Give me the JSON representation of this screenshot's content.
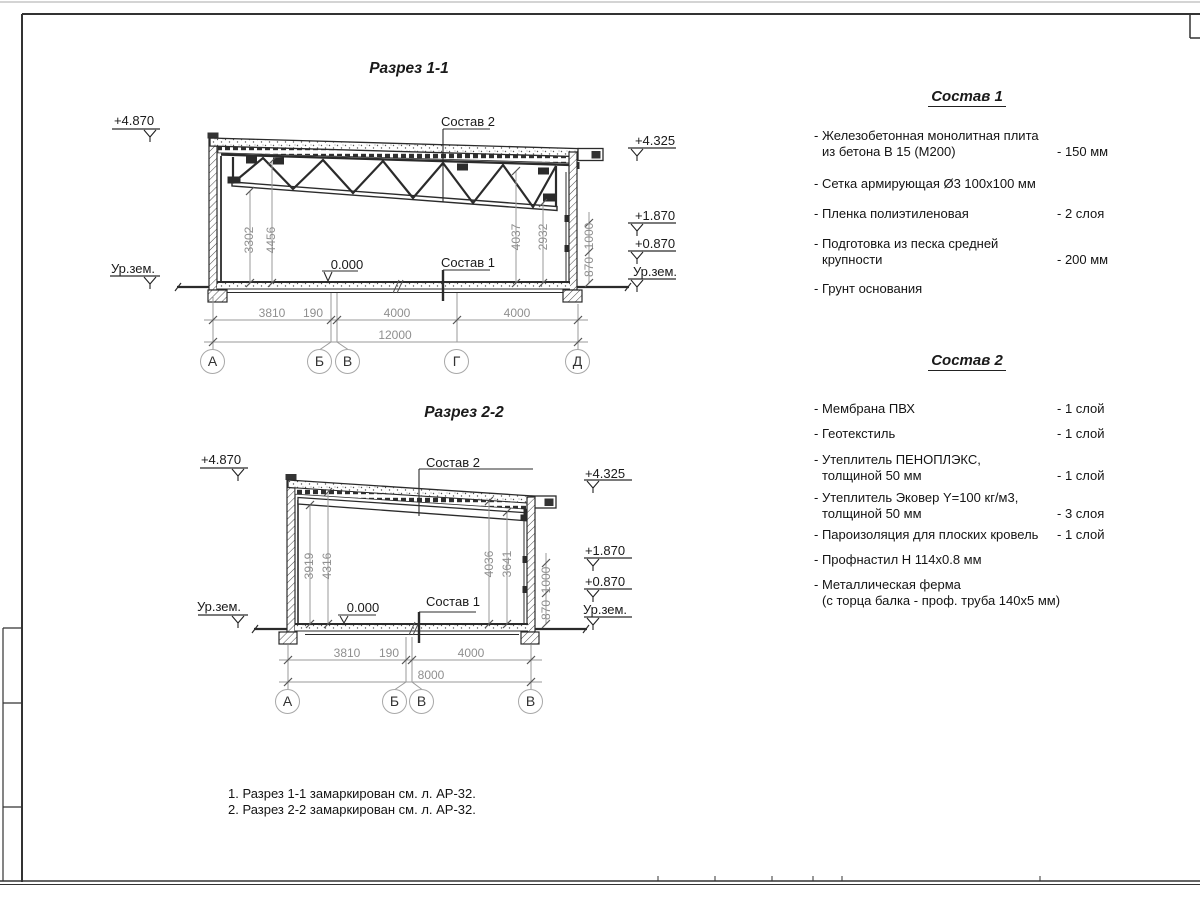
{
  "s1": {
    "title": "Разрез 1-1",
    "label_sostav2": "Состав 2",
    "label_sostav1": "Состав 1",
    "zero": "0.000",
    "mark_top_left": "+4.870",
    "mark_ground_left": "Ур.зем.",
    "marks_right": [
      "+4.325",
      "+1.870",
      "+0.870",
      "Ур.зем."
    ],
    "vdim": [
      "3302",
      "4456",
      "4037",
      "2932"
    ],
    "walldim": [
      "870",
      "1000"
    ],
    "hdim": [
      "3810",
      "190",
      "4000",
      "4000"
    ],
    "total": "12000",
    "axes": [
      "А",
      "Б",
      "В",
      "Г",
      "Д"
    ]
  },
  "s2": {
    "title": "Разрез 2-2",
    "label_sostav2": "Состав 2",
    "label_sostav1": "Состав 1",
    "zero": "0.000",
    "mark_top_left": "+4.870",
    "mark_ground_left": "Ур.зем.",
    "marks_right": [
      "+4.325",
      "+1.870",
      "+0.870",
      "Ур.зем."
    ],
    "vdim": [
      "3919",
      "4316",
      "4036",
      "3641"
    ],
    "walldim": [
      "870",
      "1000"
    ],
    "hdim": [
      "3810",
      "190",
      "4000"
    ],
    "total": "8000",
    "axes": [
      "А",
      "Б",
      "В",
      "В"
    ]
  },
  "sostav1": {
    "title": "Состав 1",
    "items": [
      {
        "line1": "- Железобетонная  монолитная плита",
        "line2": "из бетона В 15 (М200)",
        "value": "- 150 мм"
      },
      {
        "line1": "- Сетка армирующая Ø3 100х100 мм"
      },
      {
        "line1": "- Пленка полиэтиленовая",
        "value": "-  2 слоя"
      },
      {
        "line1": "- Подготовка из песка средней",
        "line2": "крупности",
        "value": "- 200 мм"
      },
      {
        "line1": "- Грунт основания"
      }
    ]
  },
  "sostav2": {
    "title": "Состав 2",
    "items": [
      {
        "line1": "- Мембрана ПВХ",
        "value": "- 1 слой"
      },
      {
        "line1": "- Геотекстиль",
        "value": "- 1 слой"
      },
      {
        "line1": "- Утеплитель ПЕНОПЛЭКС,",
        "line2": "толщиной 50 мм",
        "value": "- 1 слой"
      },
      {
        "line1": "- Утеплитель Эковер Y=100 кг/м3,",
        "line2": "толщиной 50 мм",
        "value": "- 3 слоя"
      },
      {
        "line1": "- Пароизоляция для плоских кровель",
        "value": "- 1 слой"
      },
      {
        "line1": "- Профнастил Н 114х0.8 мм"
      },
      {
        "line1": "- Металлическая ферма",
        "line2": "(с торца балка - проф. труба 140х5 мм)"
      }
    ]
  },
  "notes": [
    "1. Разрез 1-1 замаркирован см. л. АР-32.",
    "2. Разрез 2-2 замаркирован см. л. АР-32."
  ],
  "colors": {
    "line": "#2b2b2b",
    "dim": "#9a9a9a",
    "tick": "#555555"
  }
}
